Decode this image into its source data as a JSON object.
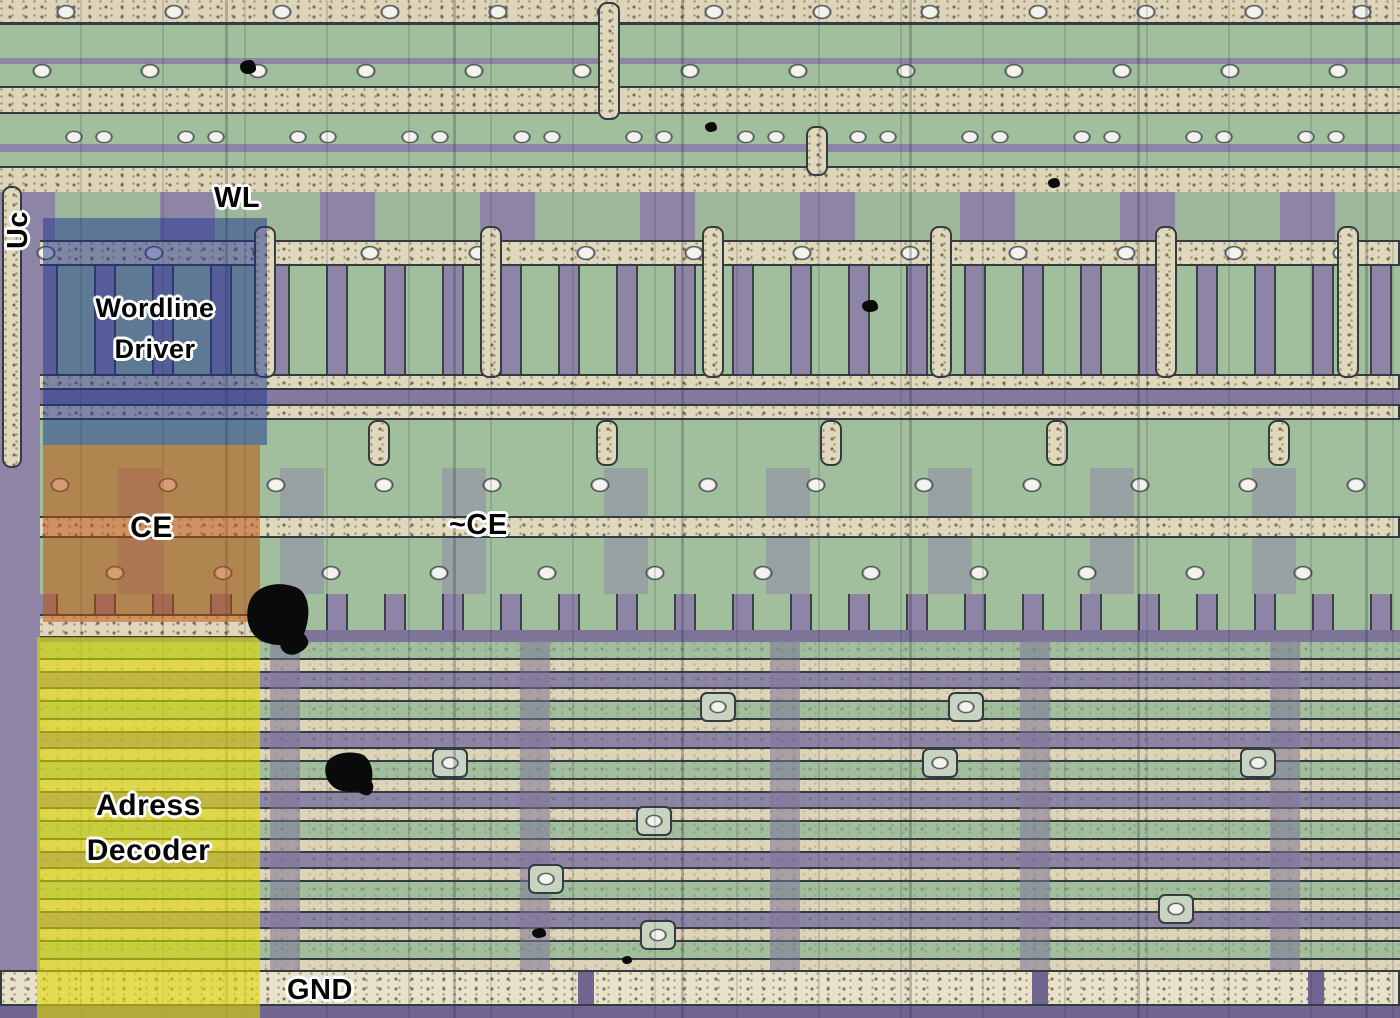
{
  "annotations": {
    "uc": "Uc",
    "wl": "WL",
    "nce": "~CE",
    "gnd": "GND",
    "regions": [
      {
        "name": "wordline-driver",
        "label": "Wordline Driver",
        "overlay_color": "#1c348c"
      },
      {
        "name": "chip-enable",
        "label": "CE",
        "overlay_color": "#be500a"
      },
      {
        "name": "address-decoder",
        "label": "Adress Decoder",
        "overlay_color": "#e1db00"
      }
    ]
  },
  "palette": {
    "substrate_purple": "#8e85a6",
    "metal_green": "#a1be9d",
    "poly_trace_beige": "#ddd4b9",
    "dark_outline": "#353c42",
    "contact_white": "#f3f2ec",
    "dust_black": "#0a0a0a",
    "label_text": "#060606",
    "label_outline": "#ffffff"
  }
}
